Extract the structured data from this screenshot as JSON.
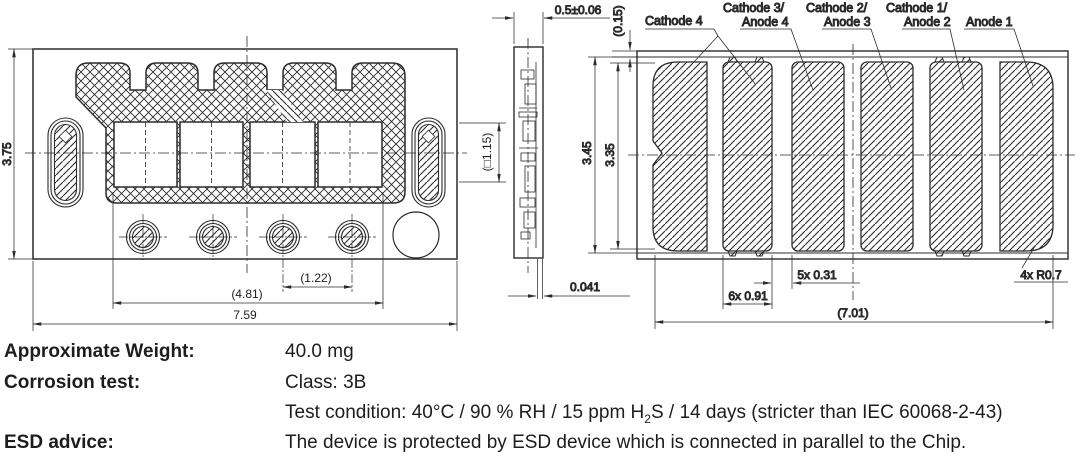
{
  "front": {
    "dim_height": "3.75",
    "dim_width": "7.59",
    "dim_span": "(4.81)",
    "dim_pitch": "(1.22)",
    "dim_chip": "(□1.15)"
  },
  "side": {
    "dim_thickness": "0.5±0.06",
    "dim_edge": "(0.15)",
    "dim_standoff": "0.041"
  },
  "bottom": {
    "label_c4": "Cathode 4",
    "label_c3": "Cathode 3/",
    "label_a4": "Anode 4",
    "label_c2": "Cathode 2/",
    "label_a3": "Anode 3",
    "label_c1": "Cathode 1/",
    "label_a2": "Anode 2",
    "label_a1": "Anode 1",
    "dim_height_outer": "3.45",
    "dim_height_pad": "3.35",
    "dim_pad_width": "6x 0.91",
    "dim_gap": "5x 0.31",
    "dim_radius": "4x R0.7",
    "dim_total_width": "(7.01)"
  },
  "specs": {
    "weight_label": "Approximate Weight:",
    "weight_value": "40.0 mg",
    "corrosion_label": "Corrosion test:",
    "corrosion_class": "Class: 3B",
    "test_condition_pre": "Test condition: 40°C / 90 % RH / 15 ppm H",
    "test_condition_sub": "2",
    "test_condition_post": "S / 14 days (stricter than IEC 60068-2-43)",
    "esd_label": "ESD advice:",
    "esd_value": "The device is protected by ESD device which is connected in parallel to the Chip."
  }
}
